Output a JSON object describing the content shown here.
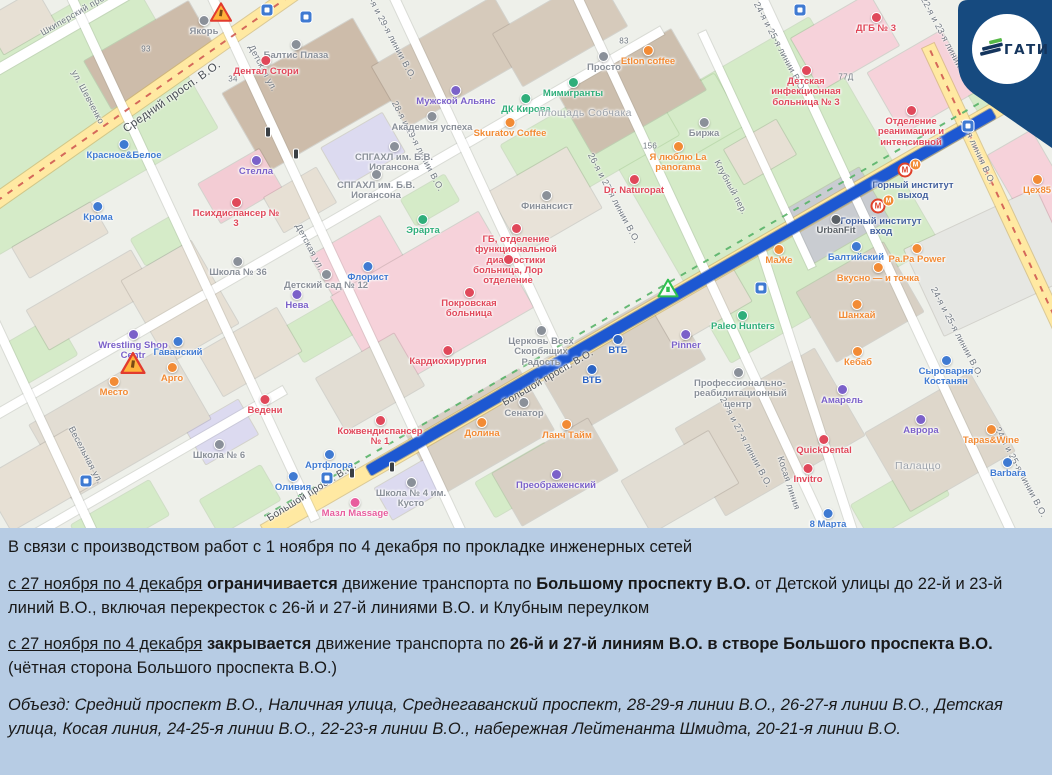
{
  "badge": {
    "logo_text": "ГАТИ",
    "badge_color": "#164a7f",
    "logo_green": "#57b947",
    "logo_navy": "#15355d"
  },
  "map": {
    "route_color": "#1d58d2",
    "pois": [
      {
        "t": "Якорь",
        "x": 204,
        "y": 22,
        "c": "#8a9099"
      },
      {
        "t": "Балтис Плаза",
        "x": 296,
        "y": 46,
        "c": "#8a9099"
      },
      {
        "t": "Дентал Стори",
        "x": 266,
        "y": 62,
        "c": "#e0485a"
      },
      {
        "t": "Красное&Белое",
        "x": 124,
        "y": 146,
        "c": "#3f7ad2"
      },
      {
        "t": "Крома",
        "x": 98,
        "y": 208,
        "c": "#3f7ad2"
      },
      {
        "t": "Стелла",
        "x": 256,
        "y": 162,
        "c": "#7b61c9"
      },
      {
        "t": "Психдиспансер № 3",
        "x": 236,
        "y": 204,
        "c": "#e0485a"
      },
      {
        "t": "Мужской Альянс",
        "x": 456,
        "y": 92,
        "c": "#7b61c9"
      },
      {
        "t": "Академия успеха",
        "x": 432,
        "y": 118,
        "c": "#8a9099"
      },
      {
        "t": "СПГАХЛ им. Б.В. Иогансона",
        "x": 394,
        "y": 148,
        "c": "#8a9099"
      },
      {
        "t": "СПГАХЛ им. Б.В. Иогансона",
        "x": 376,
        "y": 176,
        "c": "#8a9099"
      },
      {
        "t": "ДК Кирова",
        "x": 526,
        "y": 100,
        "c": "#2fae7a"
      },
      {
        "t": "Мимигранты",
        "x": 573,
        "y": 84,
        "c": "#2fae7a"
      },
      {
        "t": "Просто",
        "x": 604,
        "y": 58,
        "c": "#8a9099"
      },
      {
        "t": "Etlon coffee",
        "x": 648,
        "y": 52,
        "c": "#f28b35"
      },
      {
        "t": "Skuratov Coffee",
        "x": 510,
        "y": 124,
        "c": "#f28b35"
      },
      {
        "t": "Эрарта",
        "x": 423,
        "y": 221,
        "c": "#2fae7a"
      },
      {
        "t": "ГБ, отделение функциональной диагностики",
        "x": 516,
        "y": 230,
        "c": "#e0485a"
      },
      {
        "t": "Я люблю La panorama",
        "x": 678,
        "y": 148,
        "c": "#f28b35"
      },
      {
        "t": "Dr. Naturopat",
        "x": 634,
        "y": 181,
        "c": "#e0485a"
      },
      {
        "t": "Финансист",
        "x": 547,
        "y": 197,
        "c": "#8a9099"
      },
      {
        "t": "ДГБ № 3",
        "x": 876,
        "y": 19,
        "c": "#e0485a"
      },
      {
        "t": "Детская инфекционная больница № 3",
        "x": 806,
        "y": 72,
        "c": "#e0485a"
      },
      {
        "t": "Отделение реанимации и интенсивной",
        "x": 911,
        "y": 112,
        "c": "#e0485a"
      },
      {
        "t": "Горный институт выход",
        "x": 913,
        "y": 186,
        "c": "#44619e",
        "nodot": 1
      },
      {
        "t": "Горный институт вход",
        "x": 881,
        "y": 222,
        "c": "#44619e",
        "nodot": 1
      },
      {
        "t": "UrbanFit",
        "x": 836,
        "y": 221,
        "c": "#5a6066"
      },
      {
        "t": "Балтийский",
        "x": 856,
        "y": 248,
        "c": "#3f7ad2"
      },
      {
        "t": "МаЖе",
        "x": 779,
        "y": 251,
        "c": "#f28b35"
      },
      {
        "t": "Pa.Pa Power",
        "x": 917,
        "y": 250,
        "c": "#f28b35"
      },
      {
        "t": "Цех85",
        "x": 1037,
        "y": 181,
        "c": "#f28b35"
      },
      {
        "t": "RestoBar",
        "x": 1031,
        "y": 52,
        "c": "#e0485a",
        "nodot": 1
      },
      {
        "t": "Биржа",
        "x": 704,
        "y": 124,
        "c": "#8a9099"
      },
      {
        "t": "Wrestling Shop Centr",
        "x": 133,
        "y": 336,
        "c": "#7b61c9"
      },
      {
        "t": "Гаванский",
        "x": 178,
        "y": 343,
        "c": "#3f7ad2"
      },
      {
        "t": "Арго",
        "x": 172,
        "y": 369,
        "c": "#f28b35"
      },
      {
        "t": "Место",
        "x": 114,
        "y": 383,
        "c": "#f28b35"
      },
      {
        "t": "Нева",
        "x": 297,
        "y": 296,
        "c": "#7b61c9"
      },
      {
        "t": "Детский сад № 12",
        "x": 326,
        "y": 276,
        "c": "#8a9099"
      },
      {
        "t": "Школа № 36",
        "x": 238,
        "y": 263,
        "c": "#8a9099"
      },
      {
        "t": "Ведени",
        "x": 265,
        "y": 401,
        "c": "#e0485a"
      },
      {
        "t": "Школа № 6",
        "x": 219,
        "y": 446,
        "c": "#8a9099"
      },
      {
        "t": "Артфлора",
        "x": 329,
        "y": 456,
        "c": "#3f7ad2"
      },
      {
        "t": "Оливия",
        "x": 293,
        "y": 478,
        "c": "#3f7ad2"
      },
      {
        "t": "Мазл Massage",
        "x": 355,
        "y": 504,
        "c": "#e85d9e"
      },
      {
        "t": "Школа № 4 им. Кусто",
        "x": 411,
        "y": 484,
        "c": "#8a9099"
      },
      {
        "t": "Флорист",
        "x": 368,
        "y": 268,
        "c": "#3f7ad2"
      },
      {
        "t": "Покровская больница",
        "x": 469,
        "y": 294,
        "c": "#e0485a"
      },
      {
        "t": "больница, Лор отделение",
        "x": 508,
        "y": 261,
        "c": "#e0485a"
      },
      {
        "t": "Кардиохирургия",
        "x": 448,
        "y": 352,
        "c": "#e0485a"
      },
      {
        "t": "Кожвендиспансер № 1",
        "x": 380,
        "y": 422,
        "c": "#e0485a"
      },
      {
        "t": "Церковь Всех Скорбящих Радость",
        "x": 541,
        "y": 332,
        "c": "#8a9099"
      },
      {
        "t": "Сенатор",
        "x": 524,
        "y": 404,
        "c": "#8a9099"
      },
      {
        "t": "Долина",
        "x": 482,
        "y": 424,
        "c": "#f28b35"
      },
      {
        "t": "Ланч Тайм",
        "x": 567,
        "y": 426,
        "c": "#f28b35"
      },
      {
        "t": "ВТБ",
        "x": 618,
        "y": 341,
        "c": "#2b63c4"
      },
      {
        "t": "ВТБ",
        "x": 592,
        "y": 371,
        "c": "#2b63c4"
      },
      {
        "t": "Pinner",
        "x": 686,
        "y": 336,
        "c": "#7b61c9"
      },
      {
        "t": "Преображенский",
        "x": 556,
        "y": 476,
        "c": "#7b61c9"
      },
      {
        "t": "Paleo Hunters",
        "x": 743,
        "y": 317,
        "c": "#2fae7a"
      },
      {
        "t": "Профессионально-реабилитационный центр",
        "x": 738,
        "y": 374,
        "c": "#8a9099"
      },
      {
        "t": "Вкусно — и точка",
        "x": 878,
        "y": 269,
        "c": "#f28b35"
      },
      {
        "t": "Шанхай",
        "x": 857,
        "y": 306,
        "c": "#f28b35"
      },
      {
        "t": "Кебаб",
        "x": 858,
        "y": 353,
        "c": "#f28b35"
      },
      {
        "t": "Амарель",
        "x": 842,
        "y": 391,
        "c": "#7b61c9"
      },
      {
        "t": "Сыроварня Костанян",
        "x": 946,
        "y": 362,
        "c": "#3f7ad2"
      },
      {
        "t": "Аврора",
        "x": 921,
        "y": 421,
        "c": "#7b61c9"
      },
      {
        "t": "Tapas&Wine",
        "x": 991,
        "y": 431,
        "c": "#f28b35"
      },
      {
        "t": "QuickDental",
        "x": 824,
        "y": 441,
        "c": "#e0485a"
      },
      {
        "t": "Invitro",
        "x": 808,
        "y": 470,
        "c": "#e0485a"
      },
      {
        "t": "8 Марта",
        "x": 828,
        "y": 515,
        "c": "#3f7ad2"
      },
      {
        "t": "Barbara",
        "x": 1008,
        "y": 464,
        "c": "#3f7ad2"
      },
      {
        "t": "Палаццо",
        "x": 918,
        "y": 466,
        "c": "#9aa0a8",
        "nodot": 1,
        "area": 1
      },
      {
        "t": "площадь Собчака",
        "x": 585,
        "y": 113,
        "c": "#9aa0a8",
        "nodot": 1,
        "area": 1
      }
    ],
    "streets": [
      {
        "t": "Средний просп. В.О.",
        "x": 172,
        "y": 97,
        "r": -35,
        "s": 11.5,
        "major": 1
      },
      {
        "t": "Большой просп. В.О.",
        "x": 312,
        "y": 492,
        "r": -32,
        "s": 10,
        "major": 1
      },
      {
        "t": "Большой просп. В.О.",
        "x": 548,
        "y": 378,
        "r": -30,
        "s": 10,
        "major": 1
      },
      {
        "t": "Шкиперский просп.",
        "x": 78,
        "y": 12,
        "r": -30,
        "s": 9
      },
      {
        "t": "ул. Шевченко",
        "x": 88,
        "y": 97,
        "r": 62,
        "s": 9
      },
      {
        "t": "Детская ул.",
        "x": 263,
        "y": 68,
        "r": 62,
        "s": 9
      },
      {
        "t": "Детская ул.",
        "x": 310,
        "y": 247,
        "r": 62,
        "s": 9
      },
      {
        "t": "Весельная ул.",
        "x": 86,
        "y": 455,
        "r": 62,
        "s": 9
      },
      {
        "t": "28-я и 29-я линии В.О.",
        "x": 390,
        "y": 34,
        "r": 62,
        "s": 9
      },
      {
        "t": "28-я и 29-я линии В.О.",
        "x": 418,
        "y": 146,
        "r": 62,
        "s": 9
      },
      {
        "t": "26-я и 27-я линии В.О.",
        "x": 614,
        "y": 198,
        "r": 62,
        "s": 9
      },
      {
        "t": "26-я и 27-я линии В.О.",
        "x": 746,
        "y": 442,
        "r": 62,
        "s": 9
      },
      {
        "t": "24-я и 25-я линии В.О.",
        "x": 780,
        "y": 47,
        "r": 62,
        "s": 9
      },
      {
        "t": "24-я и 25-я линии В.О.",
        "x": 957,
        "y": 332,
        "r": 62,
        "s": 9
      },
      {
        "t": "24-я и 25-я линии В.О.",
        "x": 1021,
        "y": 472,
        "r": 62,
        "s": 9
      },
      {
        "t": "22-я и 23-я линии В.О.",
        "x": 947,
        "y": 42,
        "r": 62,
        "s": 9
      },
      {
        "t": "23-я линия В.О.",
        "x": 978,
        "y": 152,
        "r": 65,
        "s": 9
      },
      {
        "t": "Клубный пер.",
        "x": 731,
        "y": 187,
        "r": 62,
        "s": 9
      },
      {
        "t": "Косая линия",
        "x": 789,
        "y": 483,
        "r": 72,
        "s": 9
      },
      {
        "t": "93",
        "x": 146,
        "y": 49,
        "r": 0,
        "s": 8
      },
      {
        "t": "83",
        "x": 624,
        "y": 41,
        "r": 0,
        "s": 8
      },
      {
        "t": "34",
        "x": 233,
        "y": 79,
        "r": 0,
        "s": 8
      },
      {
        "t": "156",
        "x": 650,
        "y": 146,
        "r": 0,
        "s": 8
      },
      {
        "t": "77Д",
        "x": 846,
        "y": 77,
        "r": 0,
        "s": 8
      }
    ],
    "icons": [
      {
        "type": "warning-triangle-icon",
        "x": 221,
        "y": 15,
        "s": 22
      },
      {
        "type": "warning-triangle-icon",
        "x": 133,
        "y": 366,
        "s": 25
      },
      {
        "type": "roadworks-green-icon",
        "x": 668,
        "y": 291,
        "s": 21
      },
      {
        "type": "metro-icon",
        "x": 905,
        "y": 170
      },
      {
        "type": "metro-icon",
        "x": 878,
        "y": 206
      },
      {
        "type": "bus-stop-icon",
        "x": 267,
        "y": 10
      },
      {
        "type": "bus-stop-icon",
        "x": 306,
        "y": 17
      },
      {
        "type": "bus-stop-icon",
        "x": 800,
        "y": 10
      },
      {
        "type": "bus-stop-icon",
        "x": 761,
        "y": 288
      },
      {
        "type": "bus-stop-icon",
        "x": 968,
        "y": 126
      },
      {
        "type": "bus-stop-icon",
        "x": 327,
        "y": 478
      },
      {
        "type": "bus-stop-icon",
        "x": 86,
        "y": 481
      },
      {
        "type": "traffic-light-icon",
        "x": 352,
        "y": 473
      },
      {
        "type": "traffic-light-icon",
        "x": 392,
        "y": 467
      },
      {
        "type": "traffic-light-icon",
        "x": 268,
        "y": 132
      },
      {
        "type": "traffic-light-icon",
        "x": 296,
        "y": 154
      }
    ]
  },
  "panel": {
    "paragraphs": [
      {
        "style": "normal",
        "segments": [
          {
            "t": "В связи с производством работ с 1 ноября по 4 декабря по прокладке инженерных сетей"
          }
        ]
      },
      {
        "style": "normal",
        "segments": [
          {
            "t": "с 27 ноября по 4 декабря",
            "u": 1
          },
          {
            "t": " "
          },
          {
            "t": "ограничивается",
            "b": 1
          },
          {
            "t": " движение транспорта по "
          },
          {
            "t": "Большому проспекту В.О.",
            "b": 1
          },
          {
            "t": " от Детской улицы до 22-й и 23-й линий В.О., включая перекресток с 26-й и 27-й линиями В.О. и Клубным переулком"
          }
        ]
      },
      {
        "style": "normal",
        "segments": [
          {
            "t": "с 27 ноября по 4 декабря",
            "u": 1
          },
          {
            "t": " "
          },
          {
            "t": "закрывается",
            "b": 1
          },
          {
            "t": " движение транспорта по "
          },
          {
            "t": "26-й и 27-й линиям В.О. в створе Большого проспекта В.О.",
            "b": 1
          },
          {
            "t": " (чётная сторона Большого проспекта В.О.)"
          }
        ]
      },
      {
        "style": "italic",
        "segments": [
          {
            "t": "Объезд: Средний проспект В.О., Наличная улица, Среднегаванский проспект, 28-29-я линии В.О., 26-27-я линии В.О., Детская улица, Косая линия, 24-25-я линии В.О., 22-23-я линии В.О., набережная Лейтенанта Шмидта, 20-21-я линии В.О.",
            "i": 1
          }
        ]
      }
    ]
  }
}
